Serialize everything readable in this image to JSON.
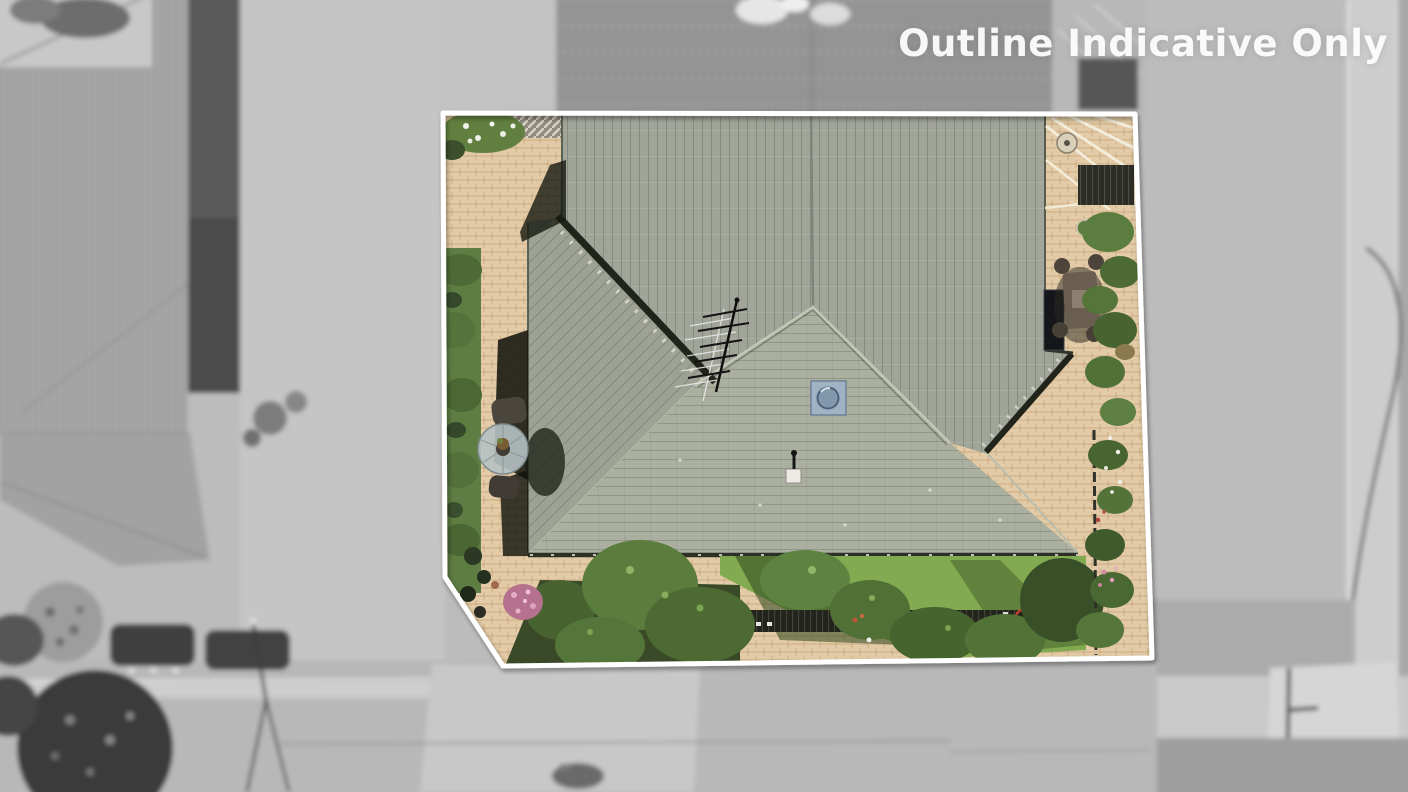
{
  "watermark": {
    "text": "Outline Indicative Only",
    "color": "#ffffff"
  },
  "scene": {
    "kind": "aerial-drone-photo",
    "subject": "single-storey house with grey tiled hip roof, brick paving and gardens inside a highlighted lot",
    "boundary": {
      "outline_color": "#ffffff",
      "shape": "rectangular lot with angled bottom-left corner",
      "treatment": "interior shown in colour, surrounding neighbourhood desaturated and blurred"
    },
    "palette": {
      "outside_gray": "#bcbcbc",
      "roof_back": "#a0a499",
      "roof_front": "#abafa0",
      "roof_wing": "#9da294",
      "paving": "#e2cba6",
      "hedge": "#5d7d42",
      "lawn": "#82ab51",
      "garden_dark": "#3a4a28",
      "skylight": "#9fb3c4",
      "valley_shadow": "#20241b"
    },
    "features": [
      "house-roof",
      "tv-antenna",
      "skylight",
      "roof-vent",
      "brick-paving",
      "garden-hedge",
      "patio-table-set",
      "outdoor-dining-set",
      "pergola",
      "garden-beds",
      "flower-bushes",
      "lawn",
      "trees",
      "dark-fence",
      "neighbour-roof",
      "driveway",
      "street",
      "footpath",
      "street-light"
    ]
  }
}
